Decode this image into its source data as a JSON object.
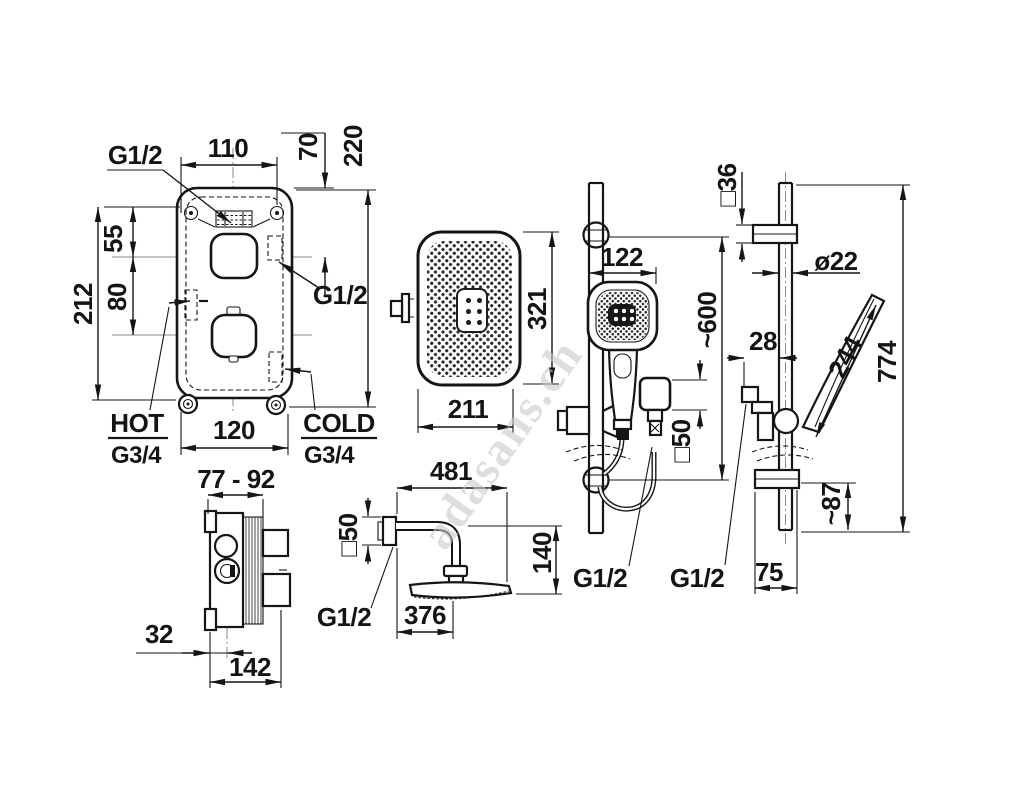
{
  "watermark": "adasans.ch",
  "colors": {
    "line": "#151515",
    "centerline": "#8a8a8a",
    "watermark": "#c9c9c9"
  },
  "trim": {
    "g12_top": "G1/2",
    "g12_side": "G1/2",
    "dim_110": "110",
    "dim_70": "70",
    "dim_220": "220",
    "dim_55": "55",
    "dim_80": "80",
    "dim_212": "212",
    "dim_120": "120",
    "hot_label": "HOT",
    "hot_thread": "G3/4",
    "cold_label": "COLD",
    "cold_thread": "G3/4"
  },
  "valve": {
    "dim_depth_range": "77 - 92",
    "dim_32": "32",
    "dim_142": "142"
  },
  "overhead": {
    "dim_321": "321",
    "dim_211": "211"
  },
  "arm": {
    "dim_481": "481",
    "dim_sq50": "□50",
    "dim_140": "140",
    "dim_376": "376",
    "thread": "G1/2"
  },
  "rail_front": {
    "dim_122": "122",
    "dim_600": "~600",
    "dim_sq50": "□50",
    "thread_hose": "G1/2",
    "thread_rail": "G1/2"
  },
  "rail_side": {
    "dim_sq36": "□36",
    "dim_d22": "ø22",
    "dim_28": "28",
    "dim_244": "244",
    "dim_774": "774",
    "dim_87": "~87",
    "dim_75": "75"
  }
}
